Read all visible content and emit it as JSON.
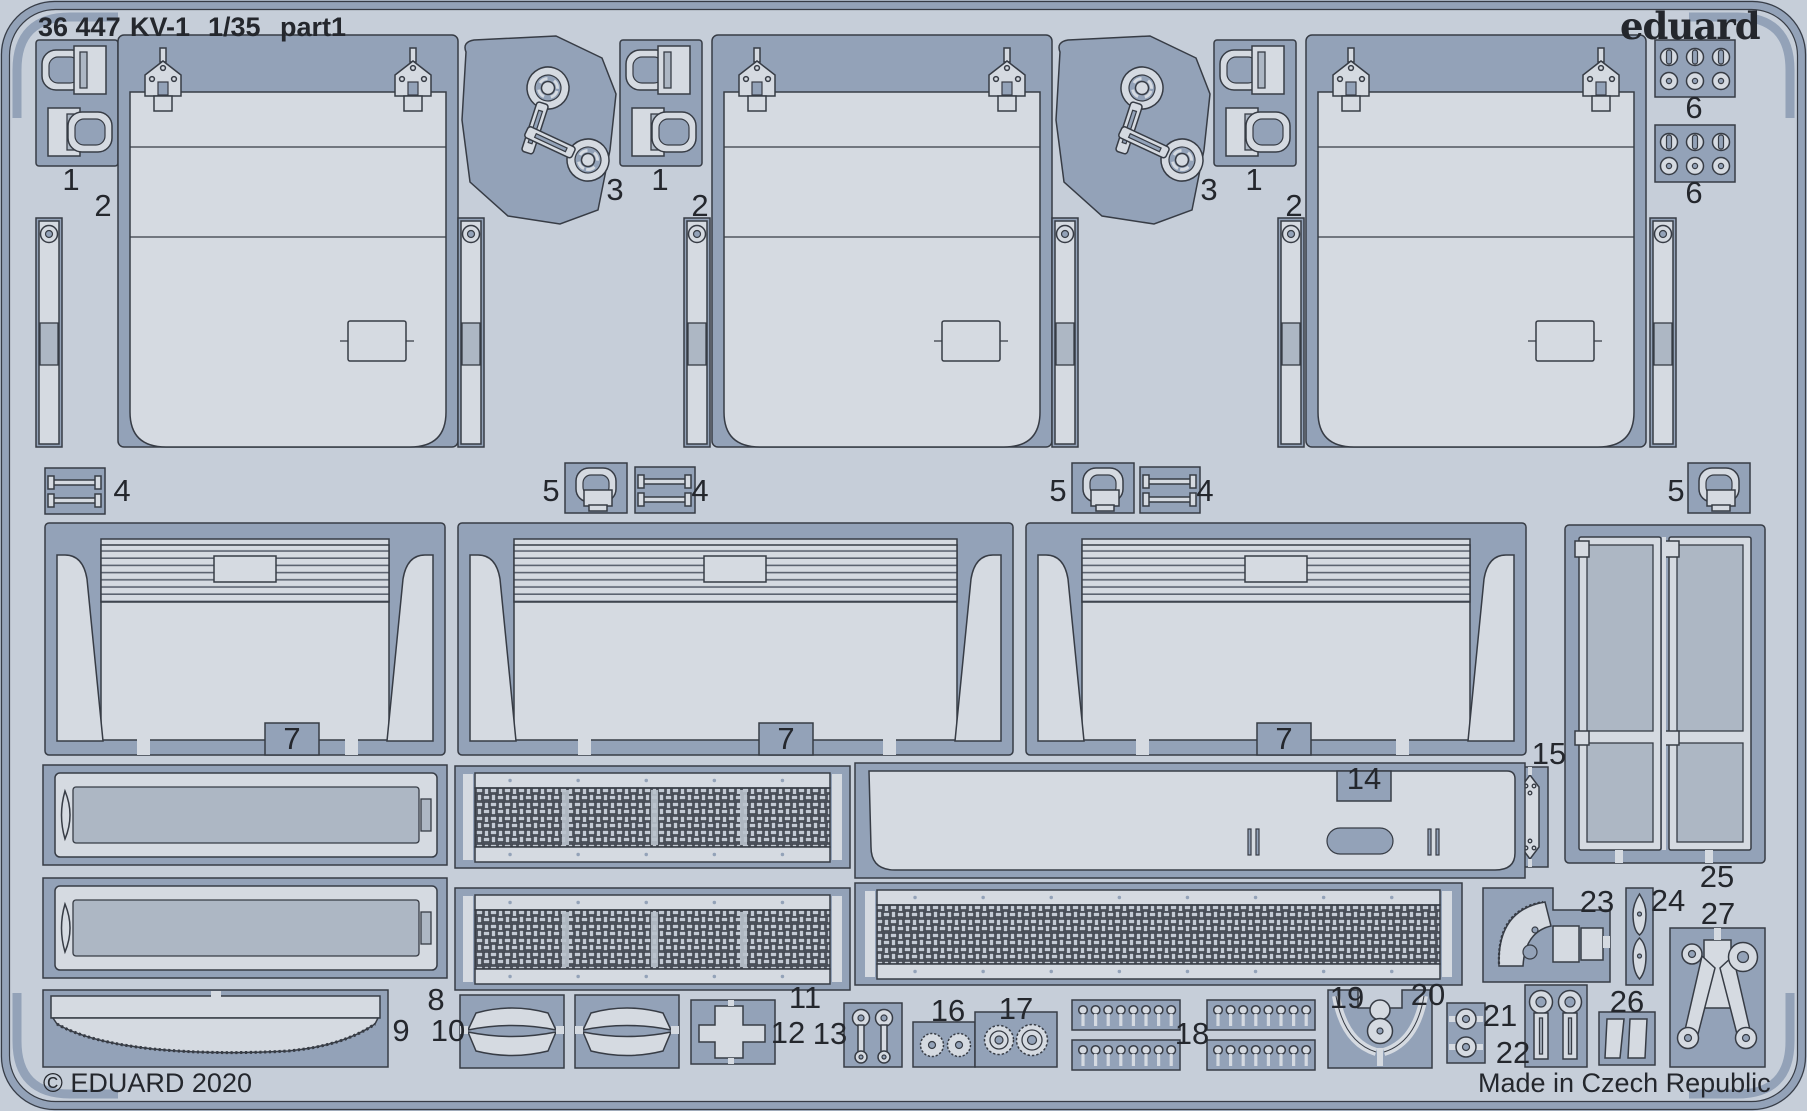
{
  "header": {
    "catalog_number": "36 447",
    "kit_name": "KV-1",
    "scale": "1/35",
    "part": "part1"
  },
  "brand": {
    "logo_text": "eduard"
  },
  "footer": {
    "copyright": "© EDUARD 2020",
    "origin": "Made in Czech Republic"
  },
  "palette": {
    "bg": "#c6ced9",
    "zone": "#93a2b8",
    "part": "#d5dae1",
    "mid": "#adb7c4",
    "ink": "#373c45",
    "ink2": "#24272d",
    "meshdark": "#4a505a",
    "meshlite": "#c3cad4"
  },
  "part_labels": [
    {
      "n": "1",
      "x": 71,
      "y": 180
    },
    {
      "n": "1",
      "x": 660,
      "y": 180
    },
    {
      "n": "1",
      "x": 1254,
      "y": 180
    },
    {
      "n": "2",
      "x": 103,
      "y": 206
    },
    {
      "n": "2",
      "x": 700,
      "y": 206
    },
    {
      "n": "2",
      "x": 1294,
      "y": 206
    },
    {
      "n": "3",
      "x": 615,
      "y": 190
    },
    {
      "n": "3",
      "x": 1209,
      "y": 190
    },
    {
      "n": "4",
      "x": 122,
      "y": 491
    },
    {
      "n": "4",
      "x": 700,
      "y": 491
    },
    {
      "n": "4",
      "x": 1205,
      "y": 491
    },
    {
      "n": "5",
      "x": 551,
      "y": 491
    },
    {
      "n": "5",
      "x": 1058,
      "y": 491
    },
    {
      "n": "5",
      "x": 1676,
      "y": 491
    },
    {
      "n": "6",
      "x": 1694,
      "y": 108
    },
    {
      "n": "6",
      "x": 1694,
      "y": 193
    },
    {
      "n": "7",
      "x": 292,
      "y": 739
    },
    {
      "n": "7",
      "x": 786,
      "y": 739
    },
    {
      "n": "7",
      "x": 1284,
      "y": 739
    },
    {
      "n": "8",
      "x": 436,
      "y": 1000
    },
    {
      "n": "9",
      "x": 401,
      "y": 1031
    },
    {
      "n": "10",
      "x": 448,
      "y": 1031
    },
    {
      "n": "11",
      "x": 805,
      "y": 998
    },
    {
      "n": "12",
      "x": 788,
      "y": 1033
    },
    {
      "n": "13",
      "x": 830,
      "y": 1034
    },
    {
      "n": "14",
      "x": 1364,
      "y": 779
    },
    {
      "n": "15",
      "x": 1549,
      "y": 754
    },
    {
      "n": "16",
      "x": 948,
      "y": 1011
    },
    {
      "n": "17",
      "x": 1016,
      "y": 1009
    },
    {
      "n": "18",
      "x": 1192,
      "y": 1034
    },
    {
      "n": "19",
      "x": 1347,
      "y": 998
    },
    {
      "n": "20",
      "x": 1428,
      "y": 995
    },
    {
      "n": "21",
      "x": 1500,
      "y": 1016
    },
    {
      "n": "22",
      "x": 1513,
      "y": 1053
    },
    {
      "n": "23",
      "x": 1597,
      "y": 902
    },
    {
      "n": "24",
      "x": 1668,
      "y": 901
    },
    {
      "n": "25",
      "x": 1717,
      "y": 877
    },
    {
      "n": "26",
      "x": 1627,
      "y": 1002
    },
    {
      "n": "27",
      "x": 1718,
      "y": 914
    }
  ]
}
